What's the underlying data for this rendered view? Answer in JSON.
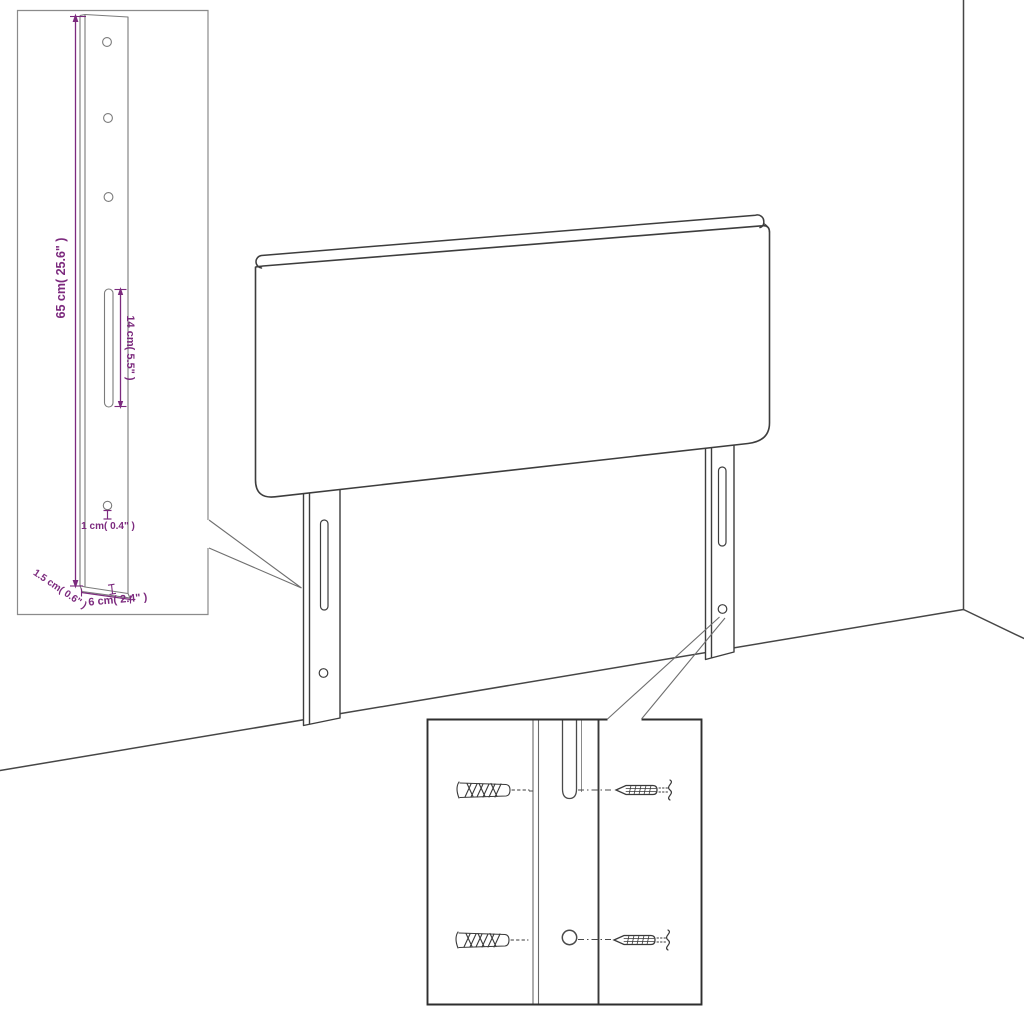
{
  "colors": {
    "line": "#3d3d3d",
    "inset_line": "#7b7b7b",
    "dimension": "#7c2a7e",
    "background": "#ffffff"
  },
  "inset_detail": {
    "height_label": "65 cm( 25.6\" )",
    "slot_label": "14 cm( 5.5\" )",
    "hole_label": "1 cm( 0.4\" )",
    "thickness_label": "1.5 cm( 0.6\" )",
    "width_label": "6 cm( 2.4\" )"
  },
  "hardware_detail": {
    "icons": [
      "wall-plug-icon",
      "screw-icon"
    ]
  }
}
